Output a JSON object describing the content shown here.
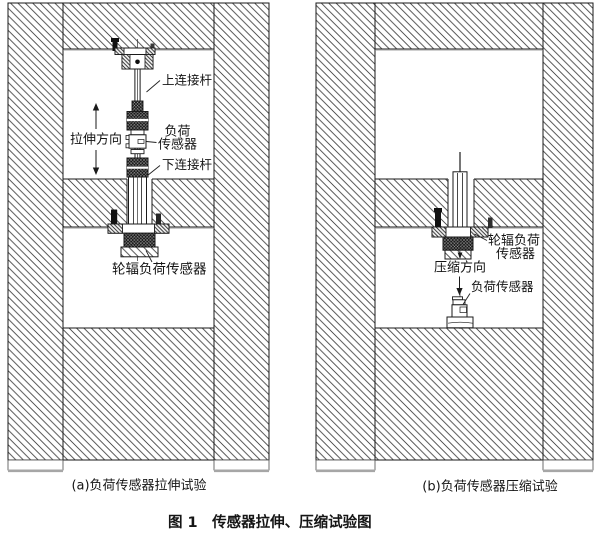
{
  "figure": {
    "caption": "图 1　传感器拉伸、压缩试验图"
  },
  "panel_a": {
    "caption": "(a)负荷传感器拉伸试验",
    "labels": {
      "upper_rod": "上连接杆",
      "direction": "拉伸方向",
      "load_sensor_1": "负荷",
      "load_sensor_2": "传感器",
      "lower_rod": "下连接杆",
      "spoke_sensor": "轮辐负荷传感器"
    }
  },
  "panel_b": {
    "caption": "(b)负荷传感器压缩试验",
    "labels": {
      "spoke_sensor_1": "轮辐负荷",
      "spoke_sensor_2": "传感器",
      "direction": "压缩方向",
      "load_sensor": "负荷传感器"
    }
  },
  "colors": {
    "ink": "#1a1a1a",
    "hatch_line": "#3f3f3f",
    "knurl_dark": "#181818",
    "foot_shadow": "#a6a6a6",
    "background": "#ffffff"
  }
}
